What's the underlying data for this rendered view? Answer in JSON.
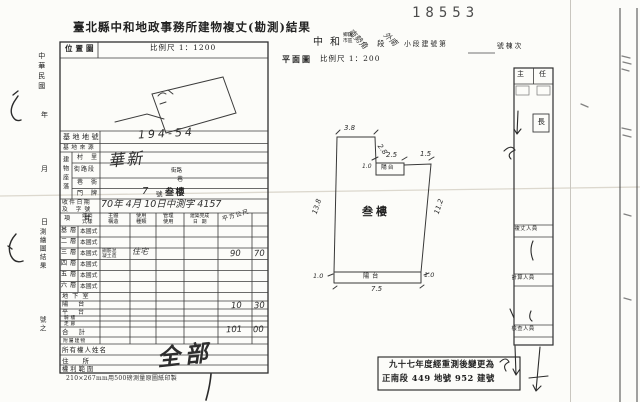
{
  "page": {
    "title": "臺北縣中和地政事務所建物複丈(勘測)結果",
    "serial": "18553",
    "footnote": "210×267mm用500磅測量原圖紙印製"
  },
  "margin": {
    "era": "中華民國",
    "year": "年",
    "month": "月",
    "day": "日",
    "result": "測繪圖結果",
    "no_suffix": "號之"
  },
  "location": {
    "label": "位置圖",
    "scale": "比例尺 1：1200"
  },
  "site": {
    "lot_label": "基地地號",
    "lot_value": "194-54",
    "source_label": "基地來源",
    "situs_label": "建物座落",
    "village": "村里",
    "street": "街路段",
    "street_value": "華新",
    "street_suffix": "街路",
    "lane": "巷衖",
    "lane_suffix": "巷",
    "door": "門牌",
    "door_no": "7",
    "door_unit": "號",
    "door_floor": "叁樓",
    "receipt_label1": "收件日期",
    "receipt_label2": "及 字號",
    "receipt_value": "70年 4月 10日中測字 4157"
  },
  "grid": {
    "h_item": "項 目",
    "h_style1": "建築",
    "h_style2": "式樣",
    "h_struct1": "主體",
    "h_struct2": "構造",
    "h_use1": "使用",
    "h_use2": "種類",
    "h_mgmt1": "管理",
    "h_mgmt2": "使用",
    "h_done1": "建築完成",
    "h_done2": "日期",
    "h_area": "平方公尺",
    "rows": [
      {
        "floor": "基層",
        "style": "本國式"
      },
      {
        "floor": "二層",
        "style": "本國式"
      },
      {
        "floor": "三層",
        "style": "本國式",
        "struct1": "鋼筋混",
        "struct2": "凝土造",
        "use": "住宅",
        "area_int": "90",
        "area_dec": "70"
      },
      {
        "floor": "四層",
        "style": "本國式"
      },
      {
        "floor": "五層",
        "style": "本國式"
      },
      {
        "floor": "六層",
        "style": "本國式"
      },
      {
        "floor": "地下室"
      },
      {
        "floor": "陽台",
        "area_int": "10",
        "area_dec": "30"
      },
      {
        "floor": "平台"
      },
      {
        "floor": "騎樓"
      },
      {
        "floor": "走廊"
      },
      {
        "floor": "合計",
        "area_int": "101",
        "area_dec": "00"
      },
      {
        "floor": "附屬建物"
      }
    ],
    "owner_label": "所有權人姓名",
    "addr_label": "住所",
    "rights_label": "權利範圍",
    "rights_value": "全部"
  },
  "plan": {
    "city_a": "中",
    "city_b": "和",
    "township_1": "鄉鎮",
    "township_2": "市區",
    "section_hand": "南勢角",
    "section": "段",
    "subsection_hand": "外南",
    "subsection": "小段建號第",
    "unit_suffix": "號棟次",
    "label": "平面圖",
    "scale": "比例尺 1：200",
    "room": "叁樓",
    "balcony_top": "陽台",
    "balcony_bottom": "陽台",
    "dims": {
      "top": "3.8",
      "notch": "2.8",
      "bal_w": "2.5",
      "bal_r": "1.5",
      "bal_h": "1.0",
      "left": "13.8",
      "right": "11.2",
      "bl": "1.0",
      "br": "1.0",
      "bottom": "7.5"
    }
  },
  "signoff": {
    "head_l": "主",
    "head_r": "任",
    "chief": "長",
    "roles": [
      "複丈人員",
      "計算人員",
      "檢查人員"
    ]
  },
  "stamp_box": {
    "line1": "九十七年度經重測後變更為",
    "line2": "正南段 449 地號 952 建號"
  }
}
